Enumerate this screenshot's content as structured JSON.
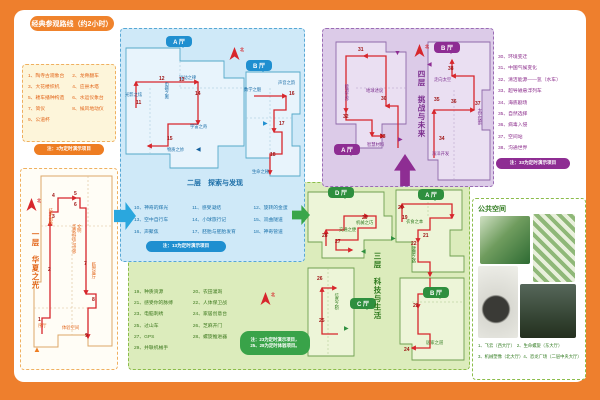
{
  "title": "经典参观路线（约2小时）",
  "misc": {
    "north": "北"
  },
  "f1": {
    "caption": "一层　华夏之光",
    "legend": [
      "1、陶寺古观象台",
      "2、龙骨翻车",
      "3、大花楼织机",
      "4、应县木塔",
      "5、耧车播种构造",
      "6、水运仪象台",
      "7、简仪",
      "8、候风地动仪",
      "9、公道杯"
    ],
    "note": "注：3为定时演示项目",
    "labels": [
      "技术创新",
      "华夏科技与世界文明",
      "临时展厅",
      "序厅",
      "体验空间"
    ],
    "points": [
      "1",
      "2",
      "3",
      "4",
      "5",
      "6",
      "7",
      "8",
      "9"
    ]
  },
  "f2": {
    "halls": [
      "A 厅",
      "B 厅"
    ],
    "caption": "二层　探索与发现",
    "labels": [
      "光影之炫",
      "电磁之奥",
      "运动之律",
      "宇宙之奇",
      "物质之妙",
      "数学之魅",
      "声音之韵",
      "生命之秘"
    ],
    "points": [
      "11",
      "12",
      "13",
      "14",
      "15",
      "16",
      "17",
      "18"
    ],
    "legend": [
      "10、神奇的辉光",
      "11、感受凝结",
      "12、旋转的金蛋",
      "13、空中自行车",
      "14、小球旅行记",
      "15、双曲隧道",
      "16、声聚焦",
      "17、胚胎与胚胎发育",
      "18、神奇管道"
    ],
    "note": "注：13为定时演示项目"
  },
  "f3": {
    "halls": [
      "A 厅",
      "B 厅",
      "C 厅",
      "D 厅"
    ],
    "caption": "三层　科技与生活",
    "labels": [
      "交通之便",
      "机械之巧",
      "衣食之本",
      "健康之路",
      "居家之道",
      "信息之桥"
    ],
    "points": [
      "19",
      "20",
      "21",
      "22",
      "23",
      "24",
      "25",
      "26",
      "27",
      "28",
      "29"
    ],
    "legend": [
      "19、种质资源",
      "20、农田灌溉",
      "21、感受你的脉搏",
      "22、人体保卫战",
      "23、电脑刺绣",
      "24、家居创意台",
      "25、过山车",
      "26、芝麻开门",
      "27、GPS",
      "28、螺旋推进器",
      "29、并联机械手"
    ],
    "note1": "注：23为定时演示项目，",
    "note2": "25、28为定时体验项目。"
  },
  "f4": {
    "halls": [
      "A 厅",
      "B 厅"
    ],
    "caption": "四层　挑战与未来",
    "labels": [
      "能源世界",
      "地球述说",
      "智慧材料",
      "走向太空",
      "太空探索",
      "海洋开发"
    ],
    "points": [
      "30",
      "31",
      "32",
      "33",
      "34",
      "35",
      "36",
      "37",
      "38"
    ],
    "legend": [
      "30、环境变迁",
      "31、中国气候变化",
      "32、清洁能源——氢（水车）",
      "33、超导磁悬浮列车",
      "34、海底剧场",
      "35、自然选择",
      "36、病毒入侵",
      "37、空间站",
      "38、沟通世界"
    ],
    "note": "注：33为定时演示项目"
  },
  "public": {
    "title": "公共空间",
    "captions": [
      "1、飞云（西大厅）　2、生命螺旋（东大厅）",
      "3、机械塑像（北大厅）4、恐龙广场（二层中央大厅）"
    ]
  }
}
